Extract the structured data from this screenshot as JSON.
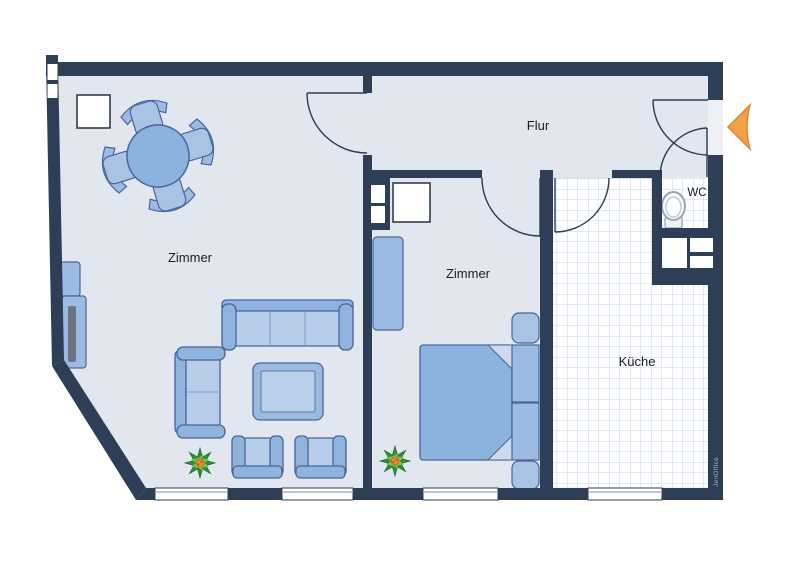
{
  "plan": {
    "type": "apartment-floor-plan",
    "rooms": [
      {
        "id": "zimmer-left",
        "label": "Zimmer"
      },
      {
        "id": "zimmer-middle",
        "label": "Zimmer"
      },
      {
        "id": "flur",
        "label": "Flur"
      },
      {
        "id": "wc",
        "label": "WC"
      },
      {
        "id": "kueche",
        "label": "Küche"
      }
    ],
    "watermark": "JenOffice",
    "entrance_marker": "orange-arrow-left",
    "furniture": [
      "round-dining-table",
      "dining-chair x4",
      "white-cabinet x2",
      "tv-sideboard",
      "sofa-3-seat",
      "sofa-2-seat",
      "coffee-table",
      "armchair x2",
      "plant x2",
      "wardrobe",
      "double-bed",
      "nightstand x2",
      "toilet"
    ],
    "colors": {
      "wall": "#2e3e56",
      "floor": "#e2e6ef",
      "tile_line": "#c3d5e5",
      "furniture": "#8fb3dd",
      "furniture_light": "#b6cbe8",
      "outline": "#49659a",
      "arrow": "#f3a148"
    }
  }
}
